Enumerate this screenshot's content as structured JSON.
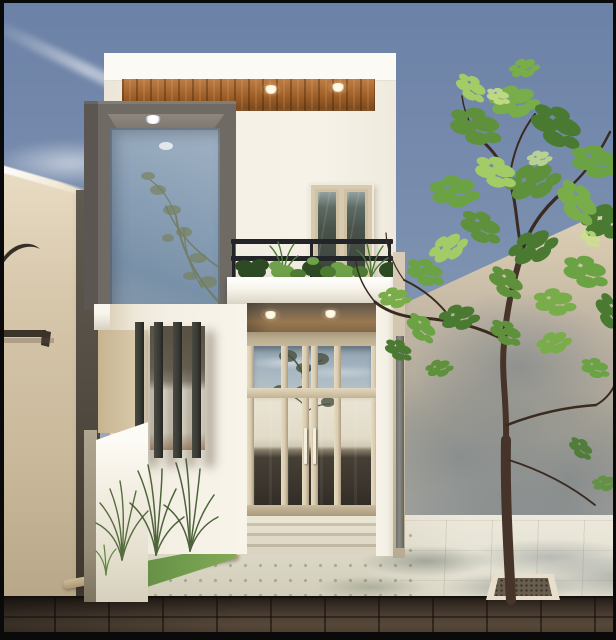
{
  "meta": {
    "type": "architectural-exterior-render",
    "description": "Photoreal 3D render of a narrow modern minimalist two-storey townhouse facade in white with a wood-clad soffit band, a protruding grey box frame around a tall corner glass panel, a balcony with black railing and potted plants, a glazed double-door entrance, a vertical louvered window, flanked by beige boundary walls, a leafy street tree, dotted pavement and a dark stone road under a clear slate-blue sky",
    "dimensions": {
      "width": 616,
      "height": 640
    }
  },
  "palette": {
    "frame-black": "#0a0a0b",
    "sky-top": "#6b81a6",
    "sky-mid": "#7e92b1",
    "sky-low": "#a5b0c1",
    "left-wall-top": "#e9ddc4",
    "left-wall": "#d6c6aa",
    "left-wall-dark": "#b7a788",
    "silhouette": "#352f27",
    "gap-shadow": "#615a50",
    "right-wall-lit": "#e0d2b9",
    "right-wall-mid": "#c0b5a4",
    "right-wall-shadow": "#9da3a4",
    "facade-white": "#f4f0e5",
    "facade-bright": "#fcfaf5",
    "wood-light": "#bd7d45",
    "wood": "#a06029",
    "wood-dark": "#7b4a1e",
    "downlight-warm": "#fff4d8",
    "downlight-cool": "#f2f7fa",
    "frame-gray": "#6f6a64",
    "frame-gray-light": "#8d8780",
    "glass-top": "#a2b3c4",
    "glass-blue": "#8aa0b6",
    "glass-deep": "#7991a8",
    "reflect-olive": "#72795a",
    "win-cream": "#d8caae",
    "win-cream-dark": "#b9ab8e",
    "win-glass-dark": "#3d463f",
    "win-glass-light": "#93a09e",
    "rail-black": "#232428",
    "slab-white": "#f8f5ee",
    "slab-shade": "#d7d1c1",
    "porch-wood": "#9a7850",
    "porch-shadow": "#5f5342",
    "door-bright": "#e9e3d3",
    "door-mid": "#d0c9b5",
    "door-dark": "#463f36",
    "door-darker": "#2c2822",
    "transom-blue": "#a6b6c1",
    "louver-dark": "#393934",
    "opening-dark": "#5a5347",
    "opening-bright": "#ebe8db",
    "opening-tan": "#b3947a",
    "side-tan": "#c7b491",
    "fence-white": "#f5f1e6",
    "fence-shade": "#aea68f",
    "grass-green": "#5e8742",
    "grass-light": "#83aa57",
    "curb-tan": "#cdbb97",
    "walk-light": "#d9d5c3",
    "walk-bright": "#e4decd",
    "road-brown": "#4b3f33",
    "road-dark": "#231d17",
    "trunk-brown": "#46342a",
    "branch-brown": "#392b20",
    "leaf-dark": "#4a7a31",
    "leaf-mid": "#5f913d",
    "leaf-bright": "#79ad4a",
    "leaf-pale": "#a3cb66",
    "plant-dark": "#2e4a25",
    "plant-mid": "#4e7a33",
    "plant-bright": "#74a647",
    "planter-rim": "#e7dfcb",
    "planter-fill": "#695d4d",
    "pipe-gray": "#8a8a84",
    "step-light": "#eae4d3",
    "step-dark": "#c9c1ac"
  },
  "scene": {
    "environment": {
      "sky": "clear slate-blue sky with one faint diagonal contrail",
      "road": "dark brown stone-slab street in shadow",
      "sidewalk": "pale dotted paving tiles crossed by soft tree shadows"
    },
    "neighbors": {
      "left_wall": "tall beige plastered boundary wall with dark curved roof and railing silhouettes",
      "right_wall": "tall beige boundary wall dappled with the street tree's shadow"
    },
    "house": {
      "storeys": 2,
      "style": "modern minimalist white render facade",
      "features": [
        "white parapet slab over a horizontal wood-plank soffit band with two recessed round downlights",
        "protruding warm-grey box frame around a full-height corner glass panel reflecting sky and branches, lit by ceiling downlights",
        "first-floor balcony with two-bar black metal railing and a row of potted plants including two small palms",
        "cream-framed double casement window with dark glass behind the balcony",
        "white balcony slab over a wood-soffit porch with two downlights",
        "full-height glazed entrance with cream mullions, transom reflecting sky and a tree, bright mid reflection band, dark lower glass and twin vertical pull handles",
        "vertical louver screen of four dark fins over a side window casting long shadows",
        "low white fence wall and a beige side return wall",
        "grey rainwater pipe on the right side return"
      ]
    },
    "vegetation": [
      "large street tree with curved dark trunk and loose clusters of sunlit green foliage planted in a square paver pit",
      "three clumps of tall wispy ornamental grass along the house base",
      "small triangular lawn patch behind a rough stone curb"
    ]
  }
}
